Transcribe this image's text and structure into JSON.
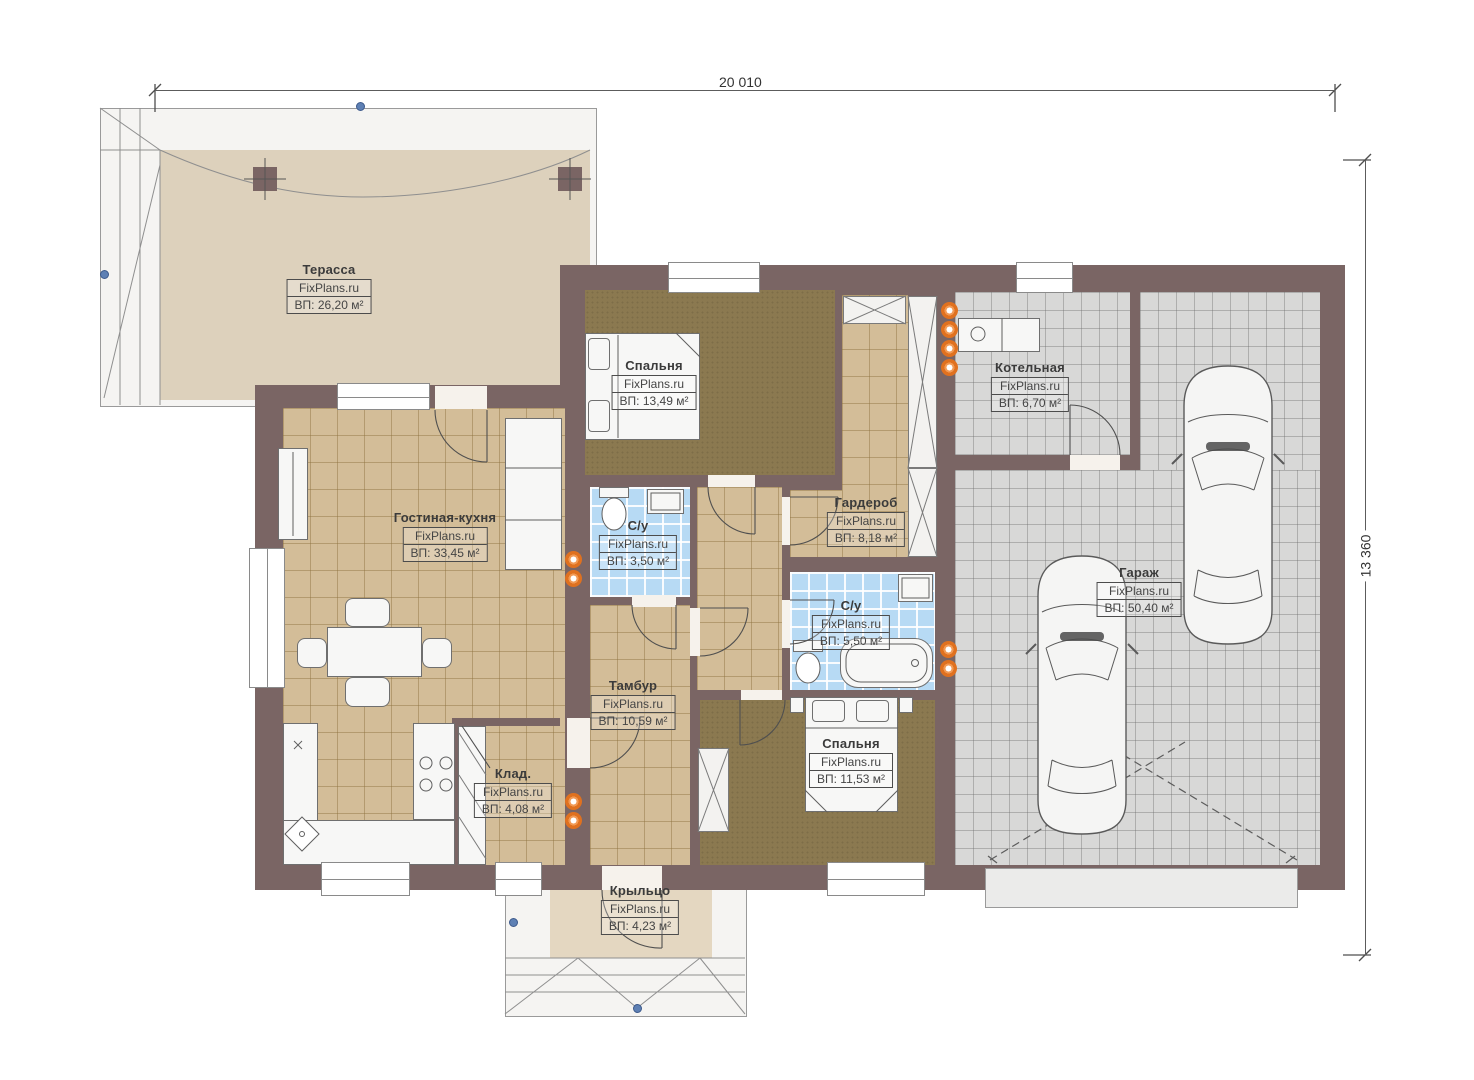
{
  "title": "Floor plan",
  "dimensions": {
    "top": "20 010",
    "right": "13 360"
  },
  "rooms": [
    {
      "id": "terrace",
      "name": "Терасса",
      "brand": "FixPlans.ru",
      "area": "ВП: 26,20 м²"
    },
    {
      "id": "bedroom-1",
      "name": "Спальня",
      "brand": "FixPlans.ru",
      "area": "ВП: 13,49 м²"
    },
    {
      "id": "boiler-room",
      "name": "Котельная",
      "brand": "FixPlans.ru",
      "area": "ВП: 6,70 м²"
    },
    {
      "id": "living-kitchen",
      "name": "Гостиная-кухня",
      "brand": "FixPlans.ru",
      "area": "ВП: 33,45 м²"
    },
    {
      "id": "bathroom-1",
      "name": "С/у",
      "brand": "FixPlans.ru",
      "area": "ВП: 3,50 м²"
    },
    {
      "id": "wardrobe",
      "name": "Гардероб",
      "brand": "FixPlans.ru",
      "area": "ВП: 8,18 м²"
    },
    {
      "id": "garage",
      "name": "Гараж",
      "brand": "FixPlans.ru",
      "area": "ВП: 50,40 м²"
    },
    {
      "id": "bathroom-2",
      "name": "С/у",
      "brand": "FixPlans.ru",
      "area": "ВП: 5,50 м²"
    },
    {
      "id": "vestibule",
      "name": "Тамбур",
      "brand": "FixPlans.ru",
      "area": "ВП: 10,59 м²"
    },
    {
      "id": "storage",
      "name": "Клад.",
      "brand": "FixPlans.ru",
      "area": "ВП: 4,08 м²"
    },
    {
      "id": "bedroom-2",
      "name": "Спальня",
      "brand": "FixPlans.ru",
      "area": "ВП: 11,53 м²"
    },
    {
      "id": "porch",
      "name": "Крыльцо",
      "brand": "FixPlans.ru",
      "area": "ВП: 4,23 м²"
    }
  ],
  "palette": {
    "wall": "#7a6564",
    "beige_tile": "#d3bd98",
    "blue_tile": "#b7daf4",
    "gray_tile": "#d8d8d7",
    "carpet": "#8b7950",
    "terrace_floor": "#ddd1bc",
    "radiator_orange": "#e0711f",
    "roof_node_blue": "#5e80b4"
  }
}
